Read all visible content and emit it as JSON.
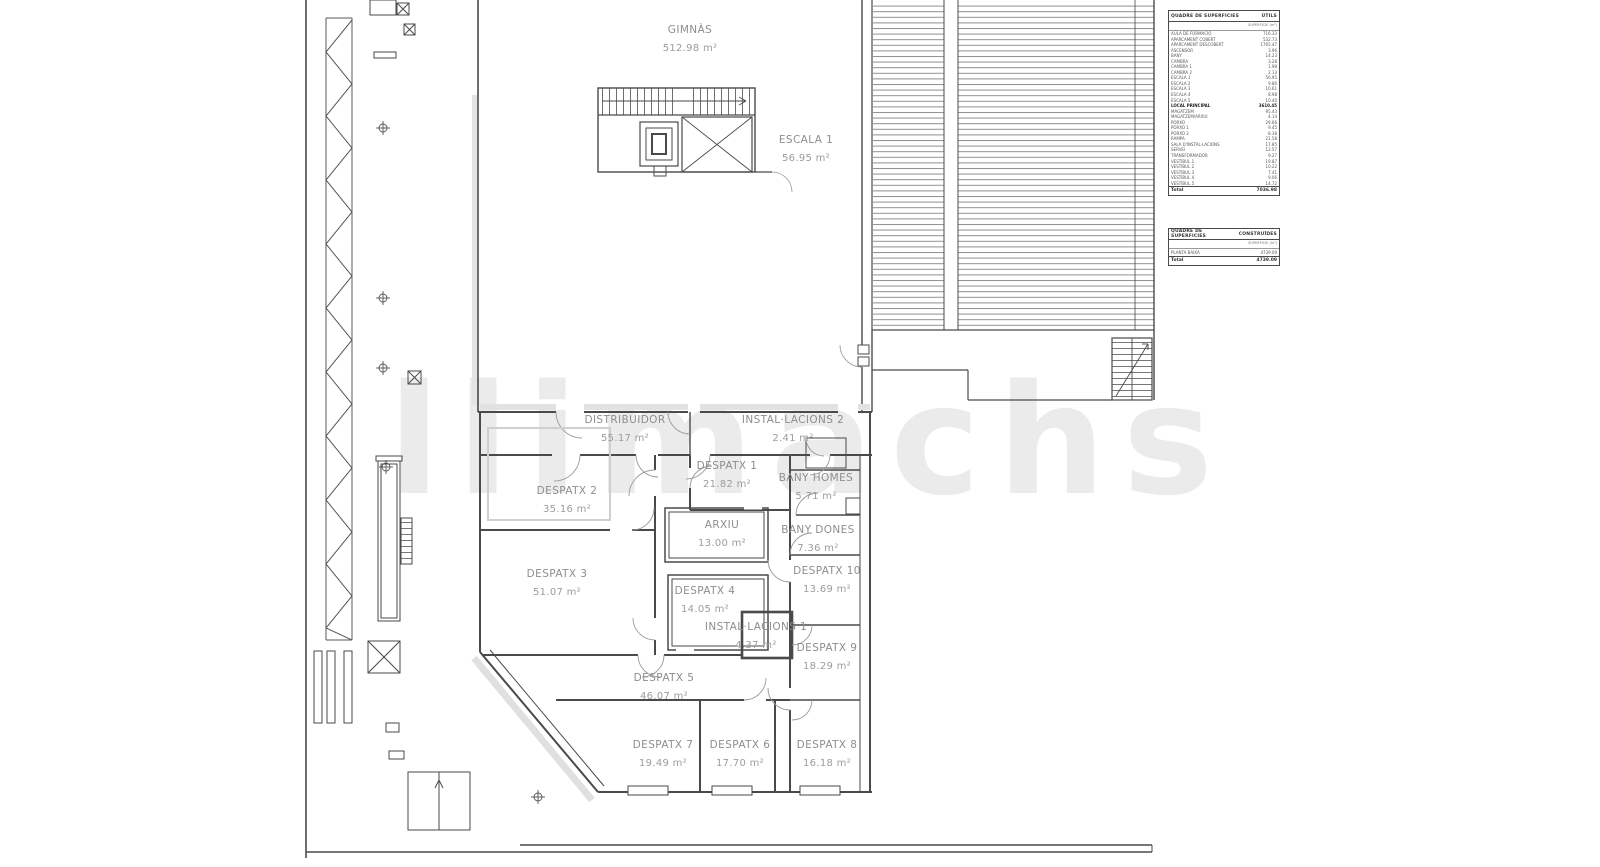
{
  "watermark": "llimachs",
  "rooms": [
    {
      "name": "GIMNÀS",
      "area": "512.98 m²"
    },
    {
      "name": "ESCALA 1",
      "area": "56.95 m²"
    },
    {
      "name": "DISTRIBUIDOR",
      "area": "55.17 m²"
    },
    {
      "name": "INSTAL·LACIONS 2",
      "area": "2.41 m²"
    },
    {
      "name": "DESPATX 1",
      "area": "21.82 m²"
    },
    {
      "name": "DESPATX 2",
      "area": "35.16 m²"
    },
    {
      "name": "BANY HOMES",
      "area": "5.71 m²"
    },
    {
      "name": "ARXIU",
      "area": "13.00 m²"
    },
    {
      "name": "BANY DONES",
      "area": "7.36 m²"
    },
    {
      "name": "DESPATX 3",
      "area": "51.07 m²"
    },
    {
      "name": "DESPATX 10",
      "area": "13.69 m²"
    },
    {
      "name": "DESPATX 4",
      "area": "14.05 m²"
    },
    {
      "name": "INSTAL·LACIONS 1",
      "area": "4.37 m²"
    },
    {
      "name": "DESPATX 9",
      "area": "18.29 m²"
    },
    {
      "name": "DESPATX 5",
      "area": "46.07 m²"
    },
    {
      "name": "DESPATX 7",
      "area": "19.49 m²"
    },
    {
      "name": "DESPATX 6",
      "area": "17.70 m²"
    },
    {
      "name": "DESPATX 8",
      "area": "16.18 m²"
    }
  ],
  "legend_utils": {
    "title": "QUADRE DE SUPERFICIES",
    "type_label": "ÚTILS",
    "col_header": "SUPERFICIE (m²)",
    "rows": [
      {
        "name": "AULA DE FORMACIÓ",
        "value": "716.33"
      },
      {
        "name": "APARCAMENT COBERT",
        "value": "532.73"
      },
      {
        "name": "APARCAMENT DESCOBERT",
        "value": "1765.47"
      },
      {
        "name": "ASCENSOR",
        "value": "3.96"
      },
      {
        "name": "BANY",
        "value": "14.23"
      },
      {
        "name": "CAMBRA",
        "value": "3.28"
      },
      {
        "name": "CAMBRA 1",
        "value": "1.98"
      },
      {
        "name": "CAMBRA 2",
        "value": "2.13"
      },
      {
        "name": "ESCALA 1",
        "value": "56.95"
      },
      {
        "name": "ESCALA 2",
        "value": "9.86"
      },
      {
        "name": "ESCALA 3",
        "value": "10.61"
      },
      {
        "name": "ESCALA 4",
        "value": "8.98"
      },
      {
        "name": "ESCALA 5",
        "value": "10.40"
      },
      {
        "name": "LOCAL PRINCIPAL",
        "value": "3610.45"
      },
      {
        "name": "MAGATZEM",
        "value": "95.43"
      },
      {
        "name": "MAGATZEM/ARXIU",
        "value": "4.14"
      },
      {
        "name": "PORXO",
        "value": "29.66"
      },
      {
        "name": "PORXO 1",
        "value": "9.45"
      },
      {
        "name": "PORXO 2",
        "value": "8.38"
      },
      {
        "name": "RAMPA",
        "value": "21.58"
      },
      {
        "name": "SALA D'INSTAL·LACIONS",
        "value": "17.85"
      },
      {
        "name": "SERVEI",
        "value": "12.57"
      },
      {
        "name": "TRANSFORMADOR",
        "value": "9.27"
      },
      {
        "name": "VESTÍBUL 1",
        "value": "19.87"
      },
      {
        "name": "VESTÍBUL 2",
        "value": "10.22"
      },
      {
        "name": "VESTÍBUL 3",
        "value": "7.41"
      },
      {
        "name": "VESTÍBUL 4",
        "value": "9.06"
      },
      {
        "name": "VESTÍBUL 5",
        "value": "14.72"
      }
    ],
    "total_label": "Total",
    "total_value": "7036.98"
  },
  "legend_built": {
    "title": "QUADRE DE SUPERFICIES",
    "type_label": "CONSTRUÏDES",
    "col_header": "SUPERFICIE (m²)",
    "rows": [
      {
        "name": "PLANTA BAIXA",
        "value": "4739.09"
      }
    ],
    "total_label": "Total",
    "total_value": "4739.09"
  }
}
